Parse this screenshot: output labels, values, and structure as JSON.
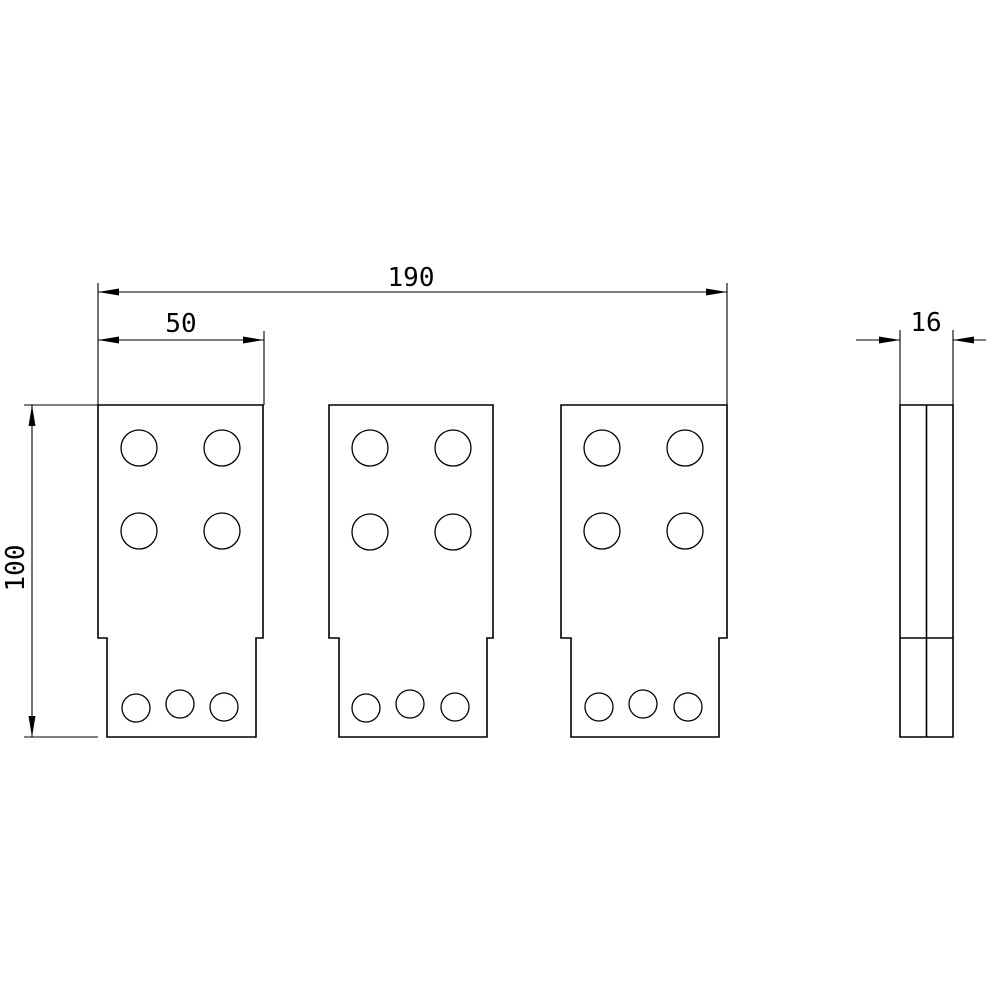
{
  "drawing": {
    "type": "technical-drawing",
    "background_color": "#ffffff",
    "line_color": "#000000",
    "dimensions": {
      "overall_width": {
        "label": "190",
        "value": 190
      },
      "plate_width": {
        "label": "50",
        "value": 50
      },
      "plate_height": {
        "label": "100",
        "value": 100
      },
      "thickness": {
        "label": "16",
        "value": 16
      }
    },
    "views": {
      "front": {
        "plate_count": 3,
        "upper_holes_per_plate": 4,
        "lower_holes_per_plate": 3,
        "stepped_profile": true
      },
      "side": {
        "center_line": true,
        "step_line": true
      }
    }
  }
}
